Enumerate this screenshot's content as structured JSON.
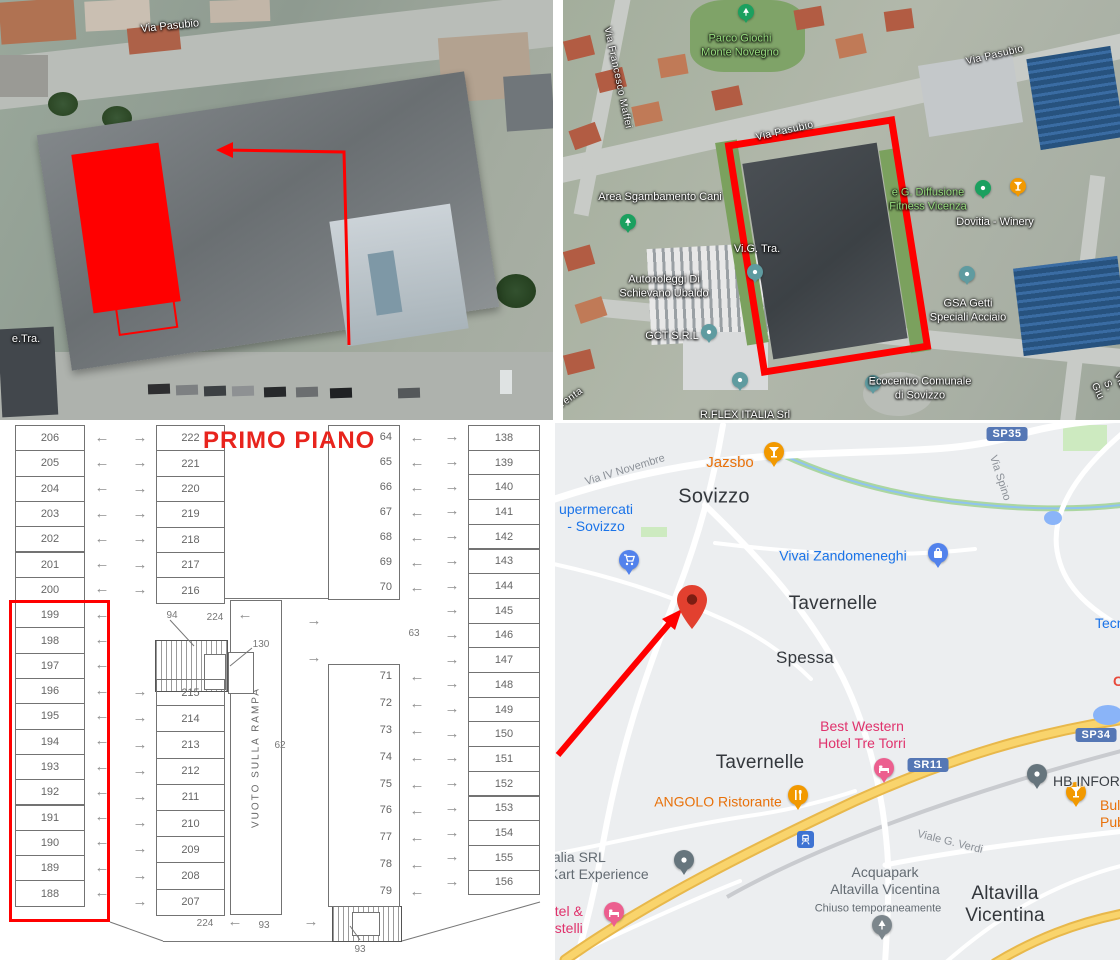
{
  "aerial_view": {
    "street_label": "Via Pasubio",
    "corner_label": "e.Tra.",
    "highlight_color": "#ff0000"
  },
  "satellite_map": {
    "highlight_color": "#ff0000",
    "pois": [
      {
        "name": "Parco Giochi\nMonte Novegno"
      },
      {
        "name": "Area Sgambamento Cani"
      },
      {
        "name": "Autonoleggi Di\nSchievano Ubaldo"
      },
      {
        "name": "Vi.G. Tra."
      },
      {
        "name": "GCT S.R.L"
      },
      {
        "name": "e G. Diffusione\nFitness Vicenza"
      },
      {
        "name": "Dovitia - Winery"
      },
      {
        "name": "GSA Getti\nSpeciali Acciaio"
      },
      {
        "name": "Ecocentro Comunale\ndi Sovizzo"
      },
      {
        "name": "R.FLEX ITALIA Srl"
      }
    ],
    "streets": [
      "Via Francesco Maffei",
      "Via Pasubio",
      "Via Pasubio",
      "renta",
      "Via S. Giu"
    ]
  },
  "floor_plan": {
    "title": "PRIMO PIANO",
    "ramp_label": "VUOTO SULLA RAMPA",
    "highlight_color": "#ff0000",
    "arrows": {
      "left": "←",
      "right": "→"
    },
    "columns": {
      "left": [
        206,
        205,
        204,
        203,
        202,
        201,
        200,
        199,
        198,
        197,
        196,
        195,
        194,
        193,
        192,
        191,
        190,
        189,
        188
      ],
      "mid_upper": [
        222,
        221,
        220,
        219,
        218,
        217,
        216
      ],
      "mid_lower": [
        215,
        214,
        213,
        212,
        211,
        210,
        209,
        208,
        207
      ],
      "inner_upper": [
        64,
        65,
        66,
        67,
        68,
        69,
        70
      ],
      "inner_lower": [
        71,
        72,
        73,
        74,
        75,
        76,
        77,
        78,
        79
      ],
      "right": [
        138,
        139,
        140,
        141,
        142,
        143,
        144,
        145,
        146,
        147,
        148,
        149,
        150,
        151,
        152,
        153,
        154,
        155,
        156
      ]
    },
    "dims": {
      "stair_top": "94",
      "aisle_top": "224",
      "storage": "130",
      "area_left": "62",
      "area_right": "63",
      "bottom_left": "224",
      "bottom_center": "93",
      "stair_bottom": "93"
    }
  },
  "road_map": {
    "towns": [
      "Sovizzo",
      "Tavernelle",
      "Spessa",
      "Tavernelle",
      "Altavilla\nVicentina"
    ],
    "route_badges": [
      "SP35",
      "SR11",
      "SP34"
    ],
    "streets": [
      "Via IV Novembre",
      "Via Spino",
      "Viale G. Verdi"
    ],
    "pois": [
      {
        "name": "Jazsbo"
      },
      {
        "name": "upermercati\n- Sovizzo"
      },
      {
        "name": "Vivai Zandomeneghi"
      },
      {
        "name": "Best Western\nHotel Tre Torri"
      },
      {
        "name": "ANGOLO Ristorante"
      },
      {
        "name": "HB INFORMATI"
      },
      {
        "name": "Bull\nPub"
      },
      {
        "name": "talia SRL\nKart Experience"
      },
      {
        "name": "otel &\nastelli"
      },
      {
        "name": "Acquapark\nAltavilla Vicentina",
        "status": "Chiuso temporaneamente"
      }
    ],
    "partial_labels": [
      "Tecn",
      "C"
    ]
  }
}
